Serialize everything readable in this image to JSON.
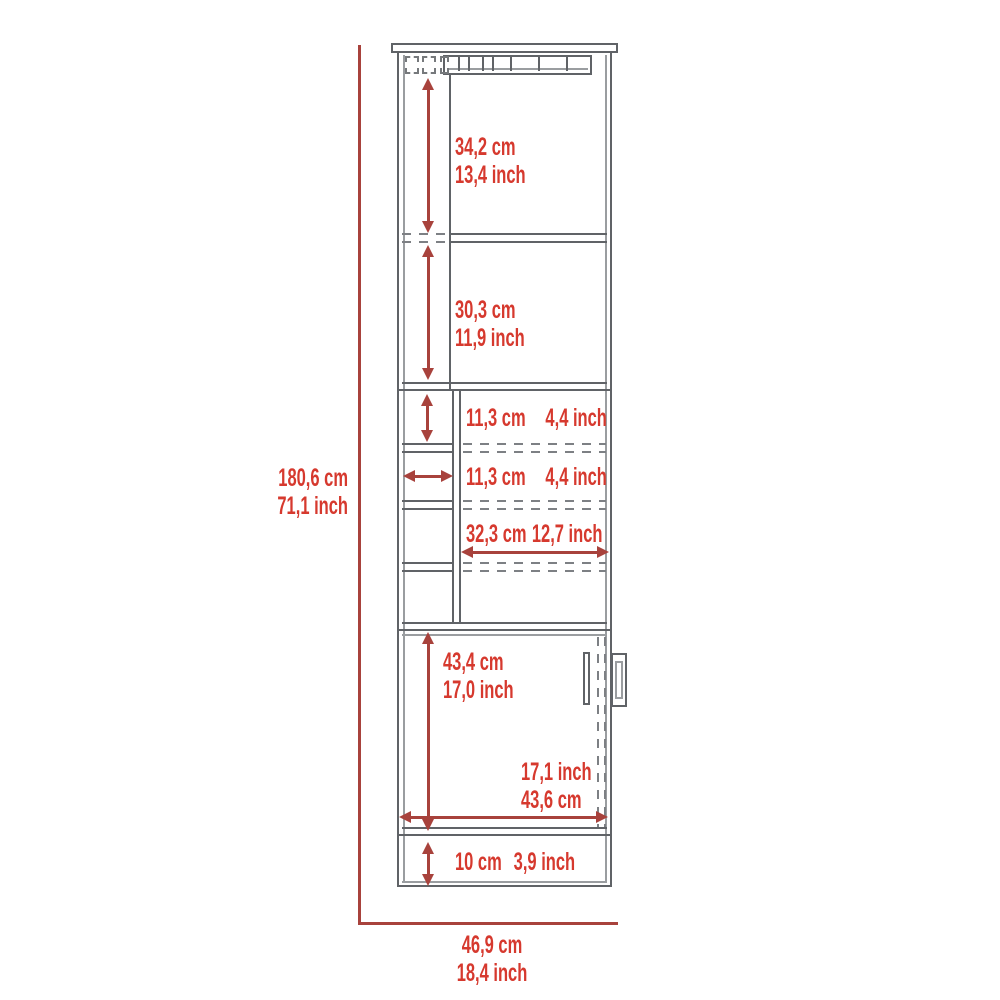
{
  "diagram": {
    "type": "furniture-dimension-diagram",
    "subject": "tall bar cabinet front view with stemware rack, cubbies, door and base",
    "colors": {
      "label_red": "#d6392e",
      "dimension_line_red": "#a8423c",
      "outline_gray": "#606367",
      "background": "#ffffff"
    },
    "overall": {
      "height_cm": "180,6 cm",
      "height_in": "71,1 inch",
      "width_cm": "46,9 cm",
      "width_in": "18,4 inch"
    },
    "top_shelf": {
      "cm": "34,2 cm",
      "in": "13,4 inch"
    },
    "mid_shelf": {
      "cm": "30,3 cm",
      "in": "11,9 inch"
    },
    "cubby_height": {
      "cm": "11,3 cm",
      "in": "4,4 inch"
    },
    "cubby_width": {
      "cm": "11,3 cm",
      "in": "4,4 inch"
    },
    "inner_width": {
      "cm": "32,3 cm",
      "in": "12,7 inch"
    },
    "door_section": {
      "h_cm": "43,4 cm",
      "h_in": "17,0 inch",
      "w_in": "17,1 inch",
      "w_cm": "43,6 cm"
    },
    "base": {
      "cm": "10 cm",
      "in": "3,9 inch"
    }
  }
}
